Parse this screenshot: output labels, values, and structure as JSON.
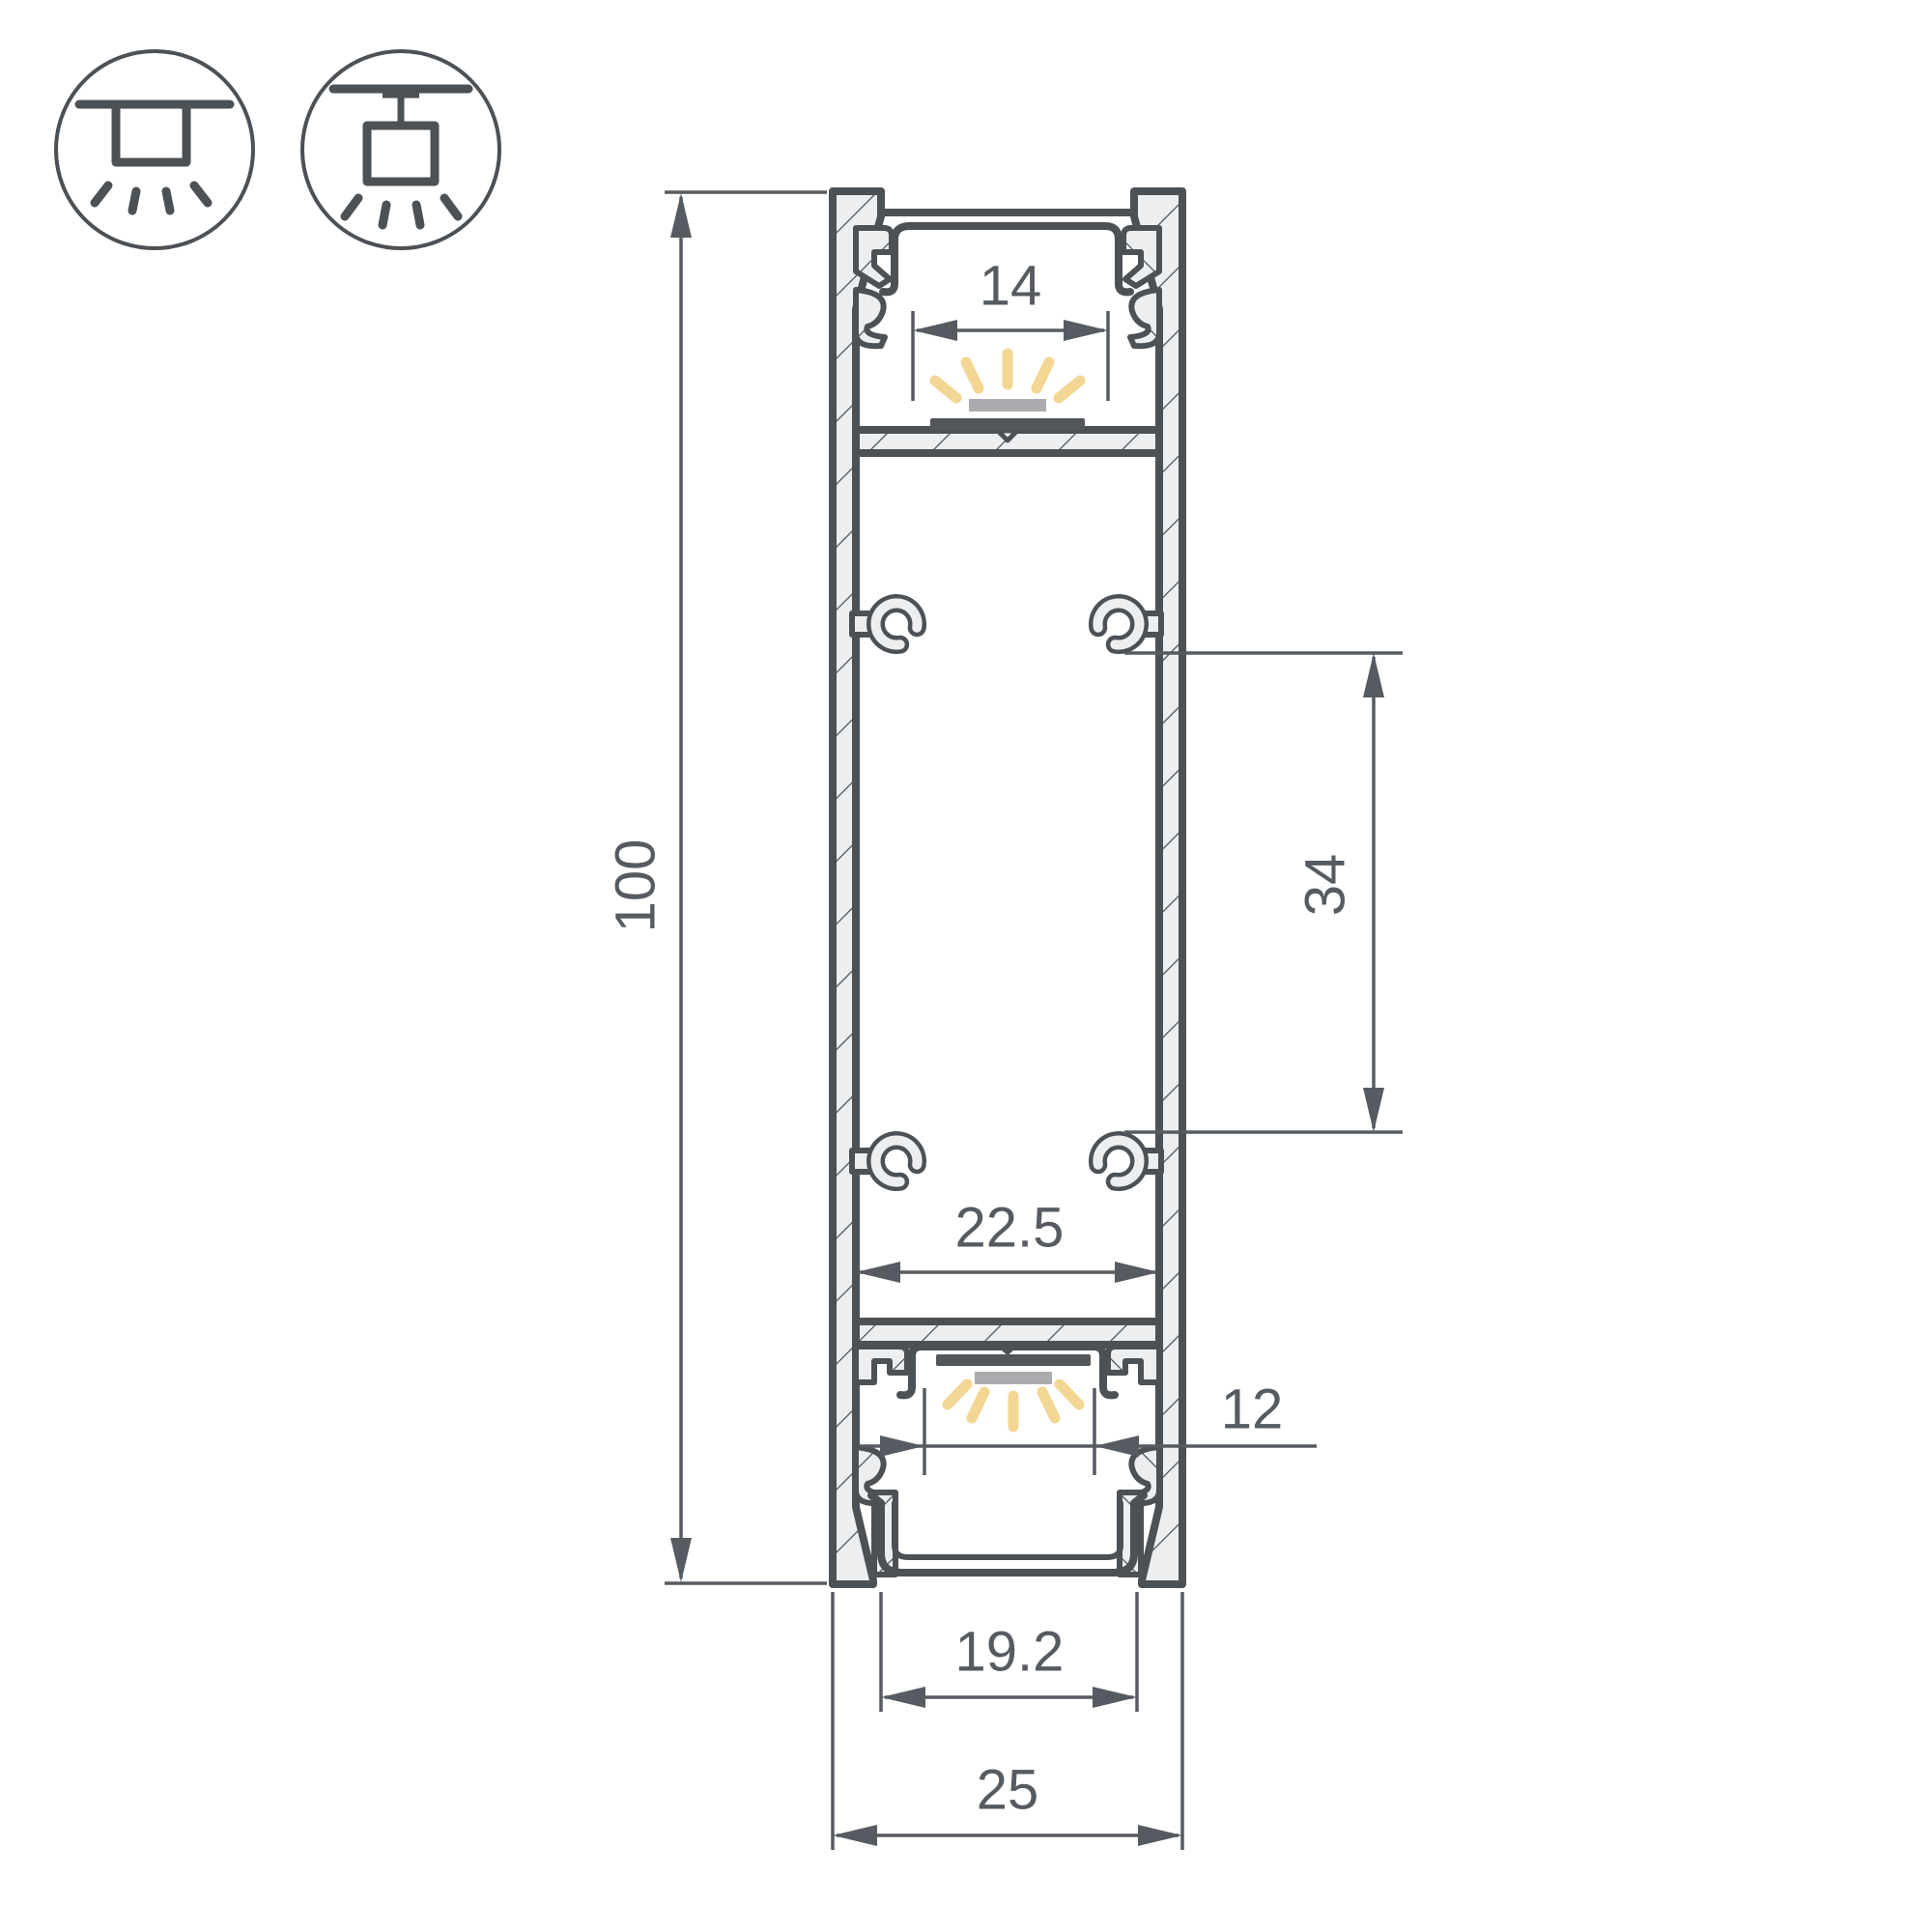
{
  "dimensions": {
    "overall_height": "100",
    "top_opening_width": "14",
    "boss_spacing": "34",
    "inner_width": "22.5",
    "bottom_window_width": "12",
    "bottom_channel_width": "19.2",
    "overall_width": "25"
  },
  "icons": [
    {
      "name": "surface-mount-light-icon"
    },
    {
      "name": "pendant-mount-light-icon"
    }
  ],
  "colors": {
    "outline": "#4c5156",
    "dimension": "#565b61",
    "metal_fill": "#eceef0",
    "led_pcb_dark": "#53575b",
    "led_module_gray": "#a9abae",
    "light_rays": "#f3d693",
    "background": "#ffffff"
  }
}
